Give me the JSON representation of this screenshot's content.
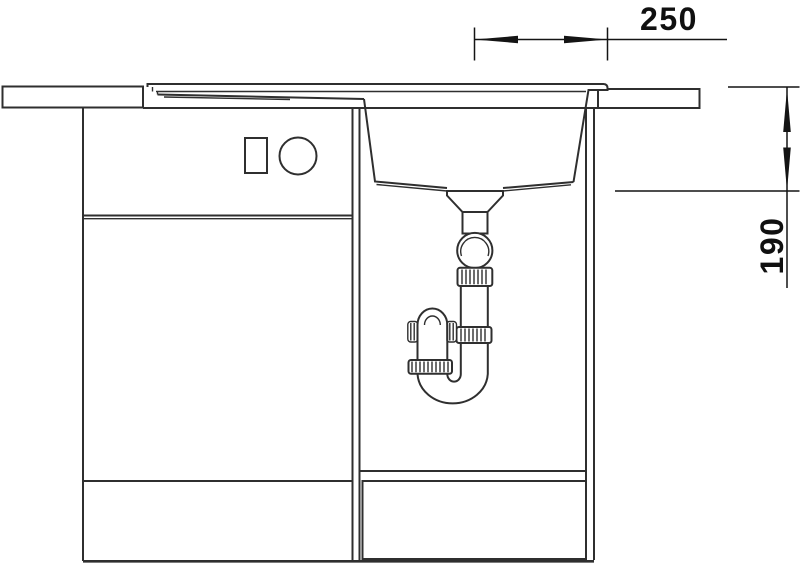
{
  "drawing": {
    "background_color": "#ffffff",
    "line_color": "#2f2f2f",
    "dimension_color": "#141414",
    "dimensions": {
      "top_width_label": "250",
      "right_depth_label": "190"
    }
  }
}
